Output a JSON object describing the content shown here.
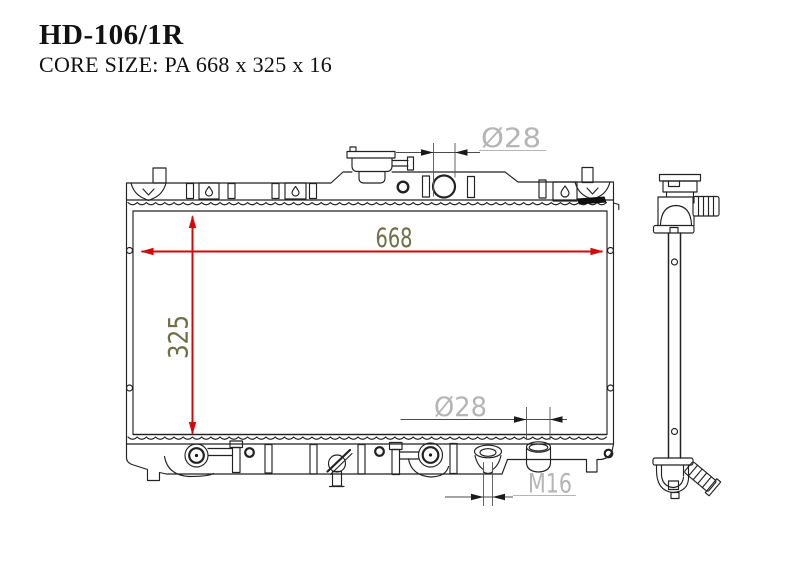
{
  "header": {
    "part_number": "HD-106/1R",
    "core_size_label": "CORE SIZE: PA 668 x 325 x 16"
  },
  "dimensions": {
    "core_width_mm": "668",
    "core_height_mm": "325",
    "top_inlet_diameter": "Ø28",
    "bottom_outlet_diameter": "Ø28",
    "drain_thread": "M16"
  },
  "colors": {
    "dimension_arrow_red": "#d40808",
    "dimension_text_olive": "#6f6f48",
    "spec_text_gray": "#b5b5b5",
    "line_art": "#222222",
    "background": "#ffffff"
  }
}
